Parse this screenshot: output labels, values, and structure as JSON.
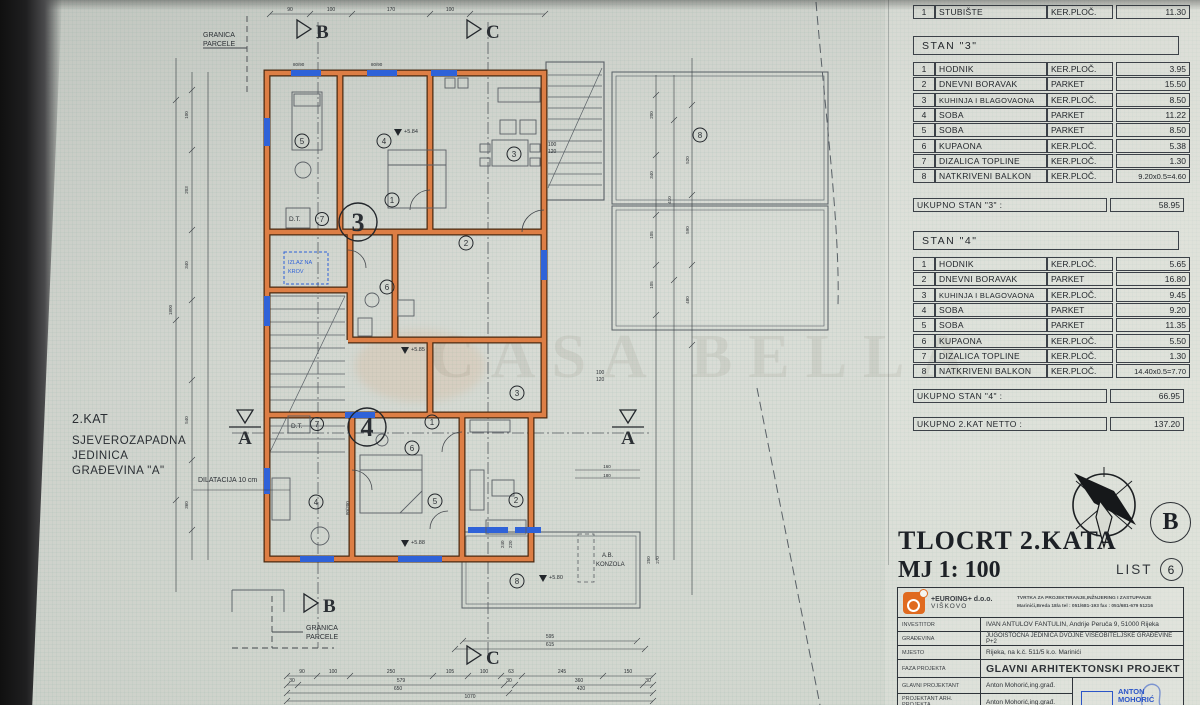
{
  "watermark": "CASA BELLA",
  "left_note": {
    "lines": [
      "2.KAT",
      "SJEVEROZAPADNA",
      "JEDINICA",
      "GRAĐEVINA \"A\""
    ]
  },
  "plan": {
    "granica_parcele": [
      "GRANICA",
      "PARCELE"
    ],
    "section_letters": {
      "a": "A",
      "b": "B",
      "c": "C"
    },
    "dilatacija": "DILATACIJA 10 cm",
    "izlaz_na_krov": [
      "IZLAZ NA",
      "KROV"
    ],
    "dt": "D.T.",
    "ab_konzola": [
      "A.B.",
      "KONZOLA"
    ],
    "apartment_numbers": {
      "three": "3",
      "four": "4"
    },
    "room_numbers": [
      "1",
      "2",
      "3",
      "4",
      "5",
      "6",
      "7",
      "8"
    ],
    "elevations": {
      "e1": "+5.84",
      "e2": "+5.85",
      "e3": "+5.88",
      "e4": "+5.80"
    },
    "win_pairs": [
      [
        "100",
        "120"
      ],
      [
        "100",
        "120"
      ],
      [
        "240",
        "220"
      ]
    ],
    "door_label": "80/200",
    "top_pairs": [
      "80/90",
      "80/90"
    ],
    "dims": {
      "top": [
        "90",
        "100",
        "170",
        "100"
      ],
      "left": [
        "1800",
        "100",
        "203",
        "340",
        "540",
        "360"
      ],
      "right": [
        "200",
        "340",
        "105",
        "105",
        "410",
        "520",
        "590",
        "480"
      ],
      "right_small": [
        "250",
        "270"
      ],
      "mid_small": [
        "160",
        "180"
      ],
      "balcony": [
        "595",
        "615"
      ],
      "bottom1": [
        "90",
        "100",
        "250",
        "105",
        "100",
        "63",
        "245",
        "150"
      ],
      "bottom2": [
        "30",
        "579",
        "30",
        "360",
        "30"
      ],
      "bottom3": [
        "650",
        "420"
      ],
      "bottom4": [
        "1070"
      ]
    }
  },
  "tables": {
    "stubiste": {
      "num": "1",
      "name": "STUBIŠTE",
      "finish": "KER.PLOČ.",
      "area": "11.30"
    },
    "stan3": {
      "title": "STAN \"3\"",
      "rows": [
        {
          "num": "1",
          "name": "HODNIK",
          "finish": "KER.PLOČ.",
          "area": "3.95"
        },
        {
          "num": "2",
          "name": "DNEVNI BORAVAK",
          "finish": "PARKET",
          "area": "15.50"
        },
        {
          "num": "3",
          "name": "KUHINJA I BLAGOVAONA",
          "finish": "KER.PLOČ.",
          "area": "8.50"
        },
        {
          "num": "4",
          "name": "SOBA",
          "finish": "PARKET",
          "area": "11.22"
        },
        {
          "num": "5",
          "name": "SOBA",
          "finish": "PARKET",
          "area": "8.50"
        },
        {
          "num": "6",
          "name": "KUPAONA",
          "finish": "KER.PLOČ.",
          "area": "5.38"
        },
        {
          "num": "7",
          "name": "DIZALICA TOPLINE",
          "finish": "KER.PLOČ.",
          "area": "1.30"
        },
        {
          "num": "8",
          "name": "NATKRIVENI BALKON",
          "finish": "KER.PLOČ.",
          "area": "9.20x0.5=4.60"
        }
      ],
      "total_label": "UKUPNO STAN \"3\" :",
      "total": "58.95"
    },
    "stan4": {
      "title": "STAN \"4\"",
      "rows": [
        {
          "num": "1",
          "name": "HODNIK",
          "finish": "KER.PLOČ.",
          "area": "5.65"
        },
        {
          "num": "2",
          "name": "DNEVNI BORAVAK",
          "finish": "PARKET",
          "area": "16.80"
        },
        {
          "num": "3",
          "name": "KUHINJA I BLAGOVAONA",
          "finish": "KER.PLOČ.",
          "area": "9.45"
        },
        {
          "num": "4",
          "name": "SOBA",
          "finish": "PARKET",
          "area": "9.20"
        },
        {
          "num": "5",
          "name": "SOBA",
          "finish": "PARKET",
          "area": "11.35"
        },
        {
          "num": "6",
          "name": "KUPAONA",
          "finish": "KER.PLOČ.",
          "area": "5.50"
        },
        {
          "num": "7",
          "name": "DIZALICA TOPLINE",
          "finish": "KER.PLOČ.",
          "area": "1.30"
        },
        {
          "num": "8",
          "name": "NATKRIVENI BALKON",
          "finish": "KER.PLOČ.",
          "area": "14.40x0.5=7.70"
        }
      ],
      "total_label": "UKUPNO STAN \"4\" :",
      "total": "66.95"
    },
    "netto": {
      "label": "UKUPNO 2.KAT NETTO :",
      "value": "137.20"
    }
  },
  "sheet": {
    "title": "TLOCRT 2.KATA",
    "scale": "MJ 1: 100",
    "list_label": "LIST",
    "list_number": "6",
    "building_letter": "B"
  },
  "titleblock": {
    "firm": {
      "name": "+EUROING+ d.o.o.",
      "city": "VIŠKOVO",
      "desc1": "TVRTKA ZA PROJEKTIRANJE,INŽNJERING I ZASTUPANJE",
      "desc2": "Marinići,Breda 18/a  tel : 051/681-193  fax : 051/681-679  51216"
    },
    "rows": [
      {
        "label": "INVESTITOR",
        "value": "IVAN ANTULOV FANTULIN, Andrije Peruča 9, 51000 Rijeka"
      },
      {
        "label": "GRAĐEVINA",
        "value": "JUGOISTOČNA JEDINICA DVOJNE VIŠEOBITELJSKE GRAĐEVINE P+2"
      },
      {
        "label": "MJESTO",
        "value": "Rijeka, na k.č. 511/5 k.o. Marinići"
      },
      {
        "label": "FAZA PROJEKTA",
        "value": "GLAVNI ARHITEKTONSKI PROJEKT"
      },
      {
        "label": "GLAVNI PROJEKTANT",
        "value": "Anton Mohorić,ing.građ."
      },
      {
        "label": "PROJEKTANT ARH. PROJEKTA",
        "value": "Anton Mohorić,ing.građ."
      }
    ],
    "stamp_name": "ANTON MOHORIĆ"
  }
}
